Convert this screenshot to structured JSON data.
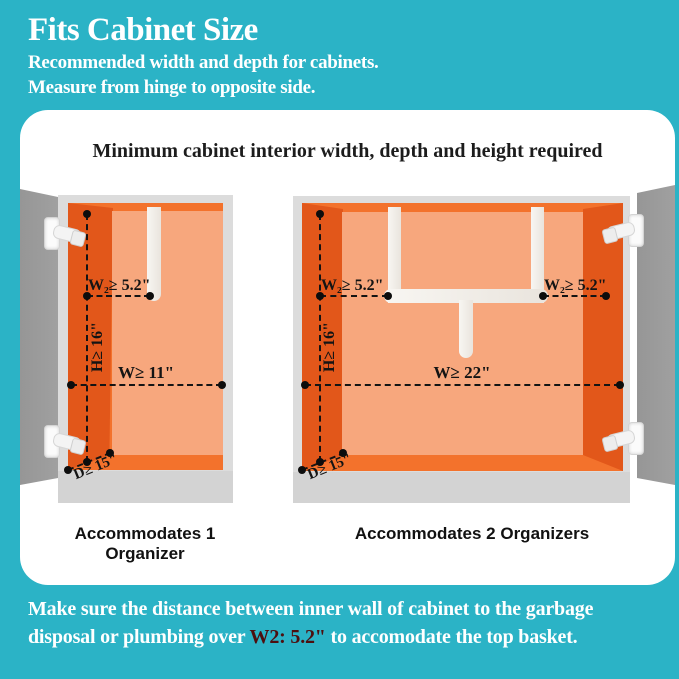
{
  "colors": {
    "background_teal": "#2bb3c6",
    "panel_white": "#ffffff",
    "cabinet_orange_dark": "#e2571a",
    "cabinet_orange_mid": "#f3722c",
    "cabinet_orange_light": "#f7a77d",
    "door_gray": "#9b9b9b",
    "frame_gray": "#dcdcdc",
    "measurement_black": "#141414",
    "highlight_red": "#4d0f0f"
  },
  "header": {
    "title": "Fits Cabinet Size",
    "subtitle_line1": "Recommended width and depth for cabinets.",
    "subtitle_line2": "Measure from hinge to opposite side."
  },
  "panel": {
    "title": "Minimum cabinet interior width, depth and height required"
  },
  "cabinet_one": {
    "caption": "Accommodates 1 Organizer",
    "measurements": {
      "w2": "W₂≥ 5.2\"",
      "h": "H≥ 16\"",
      "w": "W≥ 11\"",
      "d": "D≥ 15\""
    }
  },
  "cabinet_two": {
    "caption": "Accommodates 2 Organizers",
    "measurements": {
      "w2_left": "W₂≥ 5.2\"",
      "w2_right": "W₂≥ 5.2\"",
      "h": "H≥ 16\"",
      "w": "W≥ 22\"",
      "d": "D≥ 15\""
    }
  },
  "footer": {
    "line1": "Make sure the distance between inner wall of cabinet to the garbage",
    "line2_before": "disposal or plumbing over ",
    "highlight": "W2: 5.2\"",
    "line2_after": " to accomodate the top basket."
  }
}
